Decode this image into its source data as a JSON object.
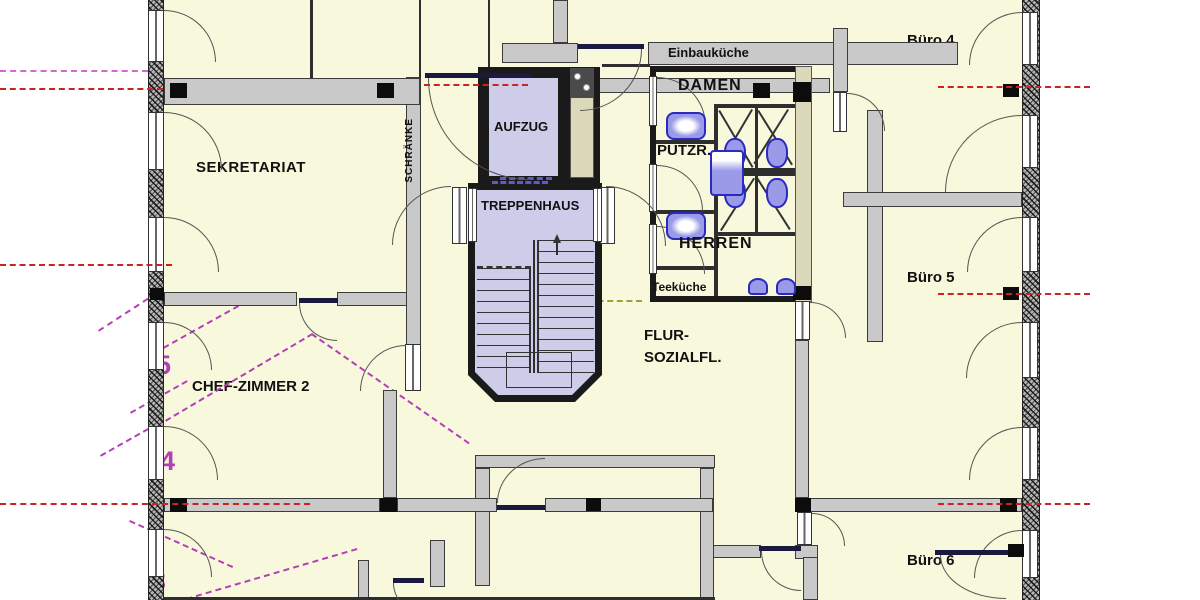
{
  "labels": {
    "sekretariat": "SEKRETARIAT",
    "chef_zimmer_2": "CHEF-ZIMMER 2",
    "aufzug": "AUFZUG",
    "treppenhaus": "TREPPENHAUS",
    "schraenke": "SCHRÄNKE",
    "einbaukueche": "Einbauküche",
    "damen": "DAMEN",
    "putzraum": "PUTZR.",
    "herren": "HERREN",
    "teekueche": "Teeküche",
    "flur_line1": "FLUR-",
    "flur_line2": "SOZIALFL.",
    "buero4": "Büro 4",
    "buero5": "Büro 5",
    "buero6": "Büro 6"
  },
  "grid_numbers": {
    "row5": "5",
    "row4": "4",
    "row3": "3"
  },
  "colors": {
    "room_fill": "#f8f8dc",
    "stair_fill": "#cdcde9",
    "wall_gray": "#c9c9c9",
    "duct_beige": "#dcd9ba",
    "centerline_red": "#cc2222",
    "grid_magenta": "#b43fb4",
    "fixture_blue": "#2a2ac0"
  }
}
